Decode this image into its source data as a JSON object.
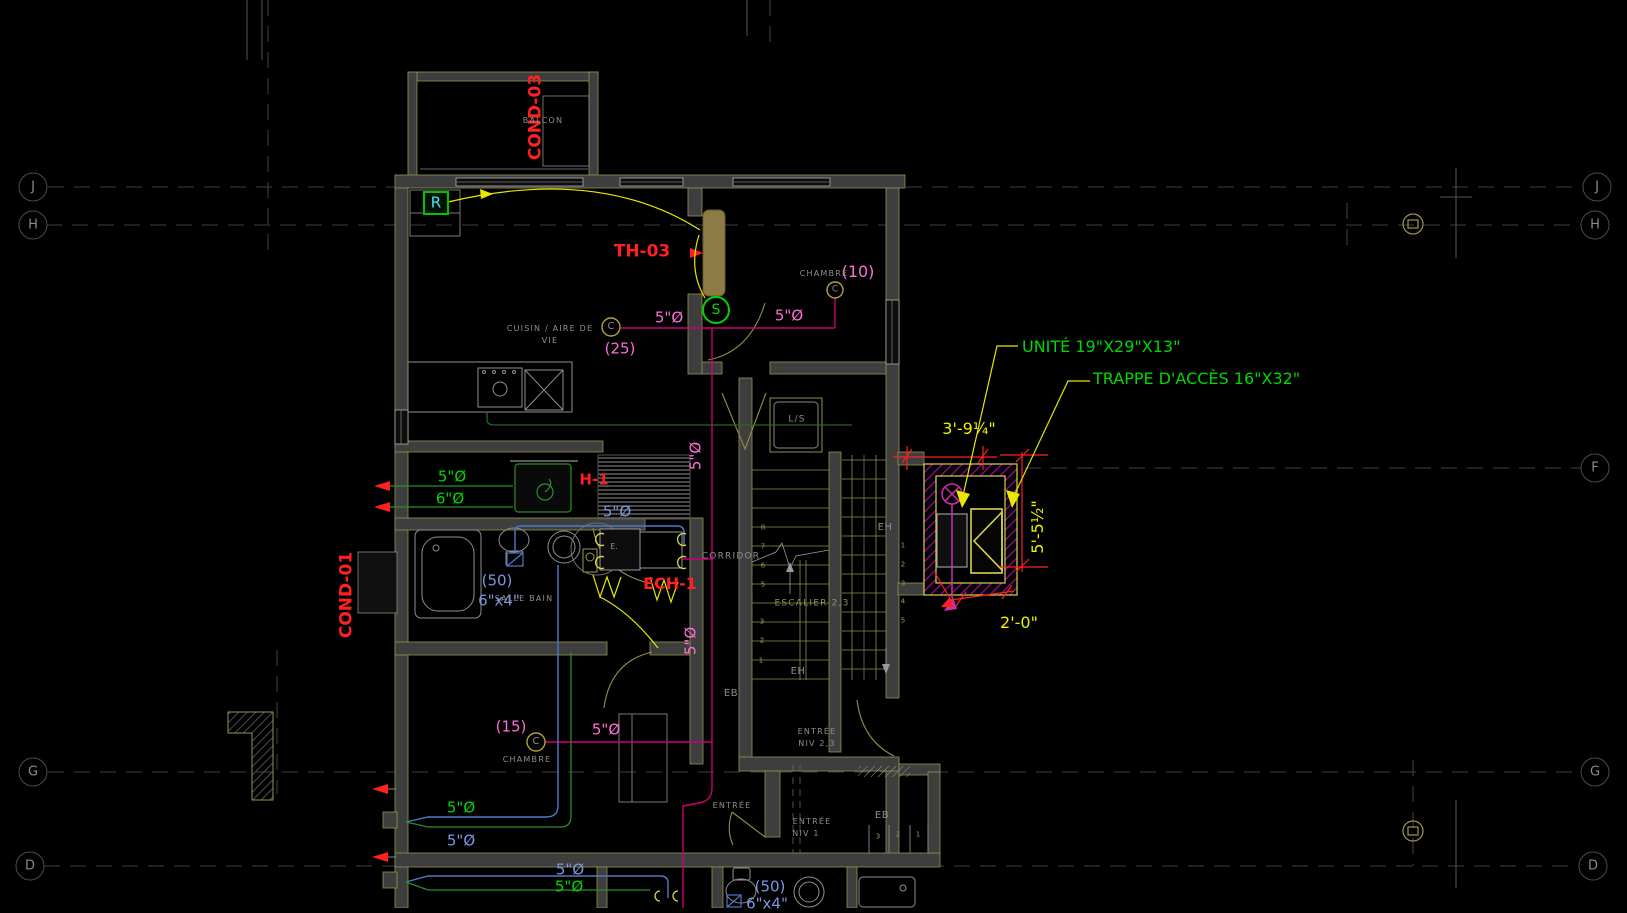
{
  "palette": {
    "red": "#ff2020",
    "green": "#00d800",
    "blue": "#7d97e0",
    "pink": "#ff6fd8",
    "yellow": "#f0f000",
    "gray": "#8f8f8f",
    "olive": "#9b9b5e",
    "olivegray": "#8f8f60",
    "cyan": "#3cecff"
  },
  "grid": {
    "bubbles": [
      {
        "label": "J",
        "x": 33,
        "y": 187,
        "side": "left"
      },
      {
        "label": "H",
        "x": 33,
        "y": 225,
        "side": "left"
      },
      {
        "label": "G",
        "x": 33,
        "y": 772,
        "side": "left"
      },
      {
        "label": "D",
        "x": 30,
        "y": 866,
        "side": "left"
      },
      {
        "label": "J",
        "x": 1597,
        "y": 187,
        "side": "right"
      },
      {
        "label": "H",
        "x": 1595,
        "y": 225,
        "side": "right"
      },
      {
        "label": "F",
        "x": 1595,
        "y": 468,
        "side": "right"
      },
      {
        "label": "G",
        "x": 1595,
        "y": 772,
        "side": "right"
      },
      {
        "label": "D",
        "x": 1593,
        "y": 866,
        "side": "right"
      }
    ]
  },
  "texts": {
    "red": [
      {
        "id": "tag-cond-03",
        "t": "COND-03",
        "x": 536,
        "y": 117,
        "s": 17,
        "rot": -90,
        "b": 1
      },
      {
        "id": "tag-cond-01",
        "t": "COND-01",
        "x": 347,
        "y": 595,
        "s": 17,
        "rot": -90,
        "b": 1
      },
      {
        "id": "tag-th-03",
        "t": "TH-03",
        "x": 642,
        "y": 252,
        "s": 17,
        "b": 1
      },
      {
        "id": "tag-h-1",
        "t": "H-1",
        "x": 594,
        "y": 480,
        "s": 15,
        "b": 1
      },
      {
        "id": "tag-ech-1",
        "t": "ECH-1",
        "x": 670,
        "y": 584,
        "s": 16,
        "b": 1
      }
    ],
    "green": [
      {
        "id": "callout-unite",
        "t": "UNITÉ 19\"X29\"X13\"",
        "x": 1022,
        "y": 347,
        "s": 16,
        "a": "l"
      },
      {
        "id": "callout-trappe",
        "t": "TRAPPE D'ACCÈS 16\"X32\"",
        "x": 1093,
        "y": 379,
        "s": 16,
        "a": "l"
      },
      {
        "id": "duct-5-kitchen",
        "t": "5\"Ø",
        "x": 452,
        "y": 477,
        "s": 15
      },
      {
        "id": "duct-6-kitchen",
        "t": "6\"Ø",
        "x": 450,
        "y": 499,
        "s": 15
      },
      {
        "id": "duct-5-mid",
        "t": "5\"Ø",
        "x": 461,
        "y": 808,
        "s": 15
      },
      {
        "id": "duct-5-bottom",
        "t": "5\"Ø",
        "x": 569,
        "y": 887,
        "s": 15
      }
    ],
    "blue": [
      {
        "id": "pipe-5-bath",
        "t": "5\"Ø",
        "x": 617,
        "y": 512,
        "s": 15
      },
      {
        "id": "note-50-bath",
        "t": "(50)",
        "x": 497,
        "y": 581,
        "s": 15
      },
      {
        "id": "note-6x4-bath",
        "t": "6\"x4\"",
        "x": 499,
        "y": 601,
        "s": 15
      },
      {
        "id": "pipe-5-mid",
        "t": "5\"Ø",
        "x": 461,
        "y": 841,
        "s": 15
      },
      {
        "id": "pipe-5-bottom",
        "t": "5\"Ø",
        "x": 570,
        "y": 870,
        "s": 15
      },
      {
        "id": "note-50-bottom",
        "t": "(50)",
        "x": 770,
        "y": 887,
        "s": 15
      },
      {
        "id": "note-6x4-bottom",
        "t": "6\"x4\"",
        "x": 767,
        "y": 904,
        "s": 15
      }
    ],
    "pink": [
      {
        "id": "pipe-5-kitchen-left",
        "t": "5\"Ø",
        "x": 669,
        "y": 318,
        "s": 15
      },
      {
        "id": "pipe-5-kitchen-right",
        "t": "5\"Ø",
        "x": 789,
        "y": 316,
        "s": 15
      },
      {
        "id": "note-25",
        "t": "(25)",
        "x": 620,
        "y": 349,
        "s": 15
      },
      {
        "id": "note-10",
        "t": "(10)",
        "x": 858,
        "y": 272,
        "s": 16
      },
      {
        "id": "note-15",
        "t": "(15)",
        "x": 511,
        "y": 727,
        "s": 15
      },
      {
        "id": "pipe-5-chambre2",
        "t": "5\"Ø",
        "x": 606,
        "y": 730,
        "s": 15
      },
      {
        "id": "pipe-5-corridor-upper",
        "t": "5\"Ø",
        "x": 696,
        "y": 456,
        "s": 15,
        "rot": -90
      },
      {
        "id": "pipe-5-corridor-lower",
        "t": "5\"Ø",
        "x": 691,
        "y": 641,
        "s": 15,
        "rot": -90
      }
    ],
    "yellow": [
      {
        "id": "dim-width",
        "t": "3'-9¼\"",
        "x": 969,
        "y": 429,
        "s": 16
      },
      {
        "id": "dim-height",
        "t": "5'-5½\"",
        "x": 1038,
        "y": 527,
        "s": 16,
        "rot": -90
      },
      {
        "id": "dim-offset",
        "t": "2'-0\"",
        "x": 1019,
        "y": 623,
        "s": 16
      }
    ],
    "rooms": [
      {
        "id": "room-balcon",
        "t": "BALCON",
        "x": 543,
        "y": 121,
        "s": 8
      },
      {
        "id": "room-cuisine-1",
        "t": "CUISIN / AIRE DE",
        "x": 550,
        "y": 329,
        "s": 8
      },
      {
        "id": "room-cuisine-2",
        "t": "VIE",
        "x": 550,
        "y": 341,
        "s": 8
      },
      {
        "id": "room-chambre-1",
        "t": "CHAMBRE",
        "x": 824,
        "y": 274,
        "s": 8
      },
      {
        "id": "room-salle-bain",
        "t": "SALLE BAIN",
        "x": 524,
        "y": 599,
        "s": 8
      },
      {
        "id": "room-corridor",
        "t": "CORRIDOR",
        "x": 731,
        "y": 557,
        "s": 9
      },
      {
        "id": "room-ls",
        "t": "L/S",
        "x": 797,
        "y": 420,
        "s": 9
      },
      {
        "id": "room-escalier",
        "t": "ESCALIER 2,3",
        "x": 812,
        "y": 604,
        "s": 9,
        "c": "olivegray"
      },
      {
        "id": "room-entree23-1",
        "t": "ENTRÉE",
        "x": 817,
        "y": 732,
        "s": 8
      },
      {
        "id": "room-entree23-2",
        "t": "NIV 2,3",
        "x": 817,
        "y": 744,
        "s": 8
      },
      {
        "id": "room-entree-g",
        "t": "ENTRÉE",
        "x": 732,
        "y": 806,
        "s": 8
      },
      {
        "id": "room-entree1-1",
        "t": "ENTRÉE",
        "x": 812,
        "y": 822,
        "s": 8
      },
      {
        "id": "room-entree1-2",
        "t": "NIV 1",
        "x": 806,
        "y": 834,
        "s": 8
      },
      {
        "id": "room-chambre-2",
        "t": "CHAMBRE",
        "x": 527,
        "y": 760,
        "s": 8
      },
      {
        "id": "lbl-eh-1",
        "t": "EH",
        "x": 885,
        "y": 528,
        "s": 10,
        "ls": 0.5
      },
      {
        "id": "lbl-eh-2",
        "t": "EH",
        "x": 798,
        "y": 672,
        "s": 10,
        "ls": 0.5
      },
      {
        "id": "lbl-eb-1",
        "t": "EB",
        "x": 731,
        "y": 694,
        "s": 10,
        "ls": 0.5
      },
      {
        "id": "lbl-eb-2",
        "t": "EB",
        "x": 882,
        "y": 816,
        "s": 10,
        "ls": 0.5
      },
      {
        "id": "lbl-e-unit",
        "t": "E.",
        "x": 614,
        "y": 547,
        "s": 8,
        "ls": 0
      }
    ],
    "symbols": [
      {
        "id": "symbol-r",
        "t": "R",
        "x": 436,
        "y": 203,
        "s": 15,
        "c": "cyan"
      },
      {
        "id": "symbol-s",
        "t": "S",
        "x": 716,
        "y": 310,
        "s": 14,
        "c": "green"
      },
      {
        "id": "symbol-c-kitchen",
        "t": "C",
        "x": 611,
        "y": 327,
        "s": 10,
        "c": "gray"
      },
      {
        "id": "symbol-c-chambre1",
        "t": "C",
        "x": 835,
        "y": 290,
        "s": 9,
        "c": "gray"
      },
      {
        "id": "symbol-c-chambre2",
        "t": "C",
        "x": 536,
        "y": 742,
        "s": 10,
        "c": "gray"
      }
    ],
    "stairs": [
      {
        "id": "step-l-8",
        "t": "8",
        "x": 763,
        "y": 528,
        "s": 7
      },
      {
        "id": "step-l-7",
        "t": "7",
        "x": 763,
        "y": 547,
        "s": 7
      },
      {
        "id": "step-l-6",
        "t": "6",
        "x": 763,
        "y": 566,
        "s": 7
      },
      {
        "id": "step-l-5",
        "t": "5",
        "x": 763,
        "y": 585,
        "s": 7
      },
      {
        "id": "step-l-3",
        "t": "3",
        "x": 762,
        "y": 622,
        "s": 7
      },
      {
        "id": "step-l-2",
        "t": "2",
        "x": 762,
        "y": 641,
        "s": 7
      },
      {
        "id": "step-l-1",
        "t": "1",
        "x": 761,
        "y": 661,
        "s": 7
      },
      {
        "id": "step-r-1",
        "t": "1",
        "x": 903,
        "y": 546,
        "s": 7
      },
      {
        "id": "step-r-2",
        "t": "2",
        "x": 903,
        "y": 565,
        "s": 7
      },
      {
        "id": "step-r-3",
        "t": "3",
        "x": 903,
        "y": 584,
        "s": 7
      },
      {
        "id": "step-r-4",
        "t": "4",
        "x": 903,
        "y": 602,
        "s": 7
      },
      {
        "id": "step-r-5",
        "t": "5",
        "x": 903,
        "y": 621,
        "s": 7
      },
      {
        "id": "step-e-3",
        "t": "3",
        "x": 878,
        "y": 837,
        "s": 7
      },
      {
        "id": "step-e-2",
        "t": "2",
        "x": 898,
        "y": 835,
        "s": 7
      },
      {
        "id": "step-e-1",
        "t": "1",
        "x": 918,
        "y": 835,
        "s": 7
      }
    ]
  }
}
